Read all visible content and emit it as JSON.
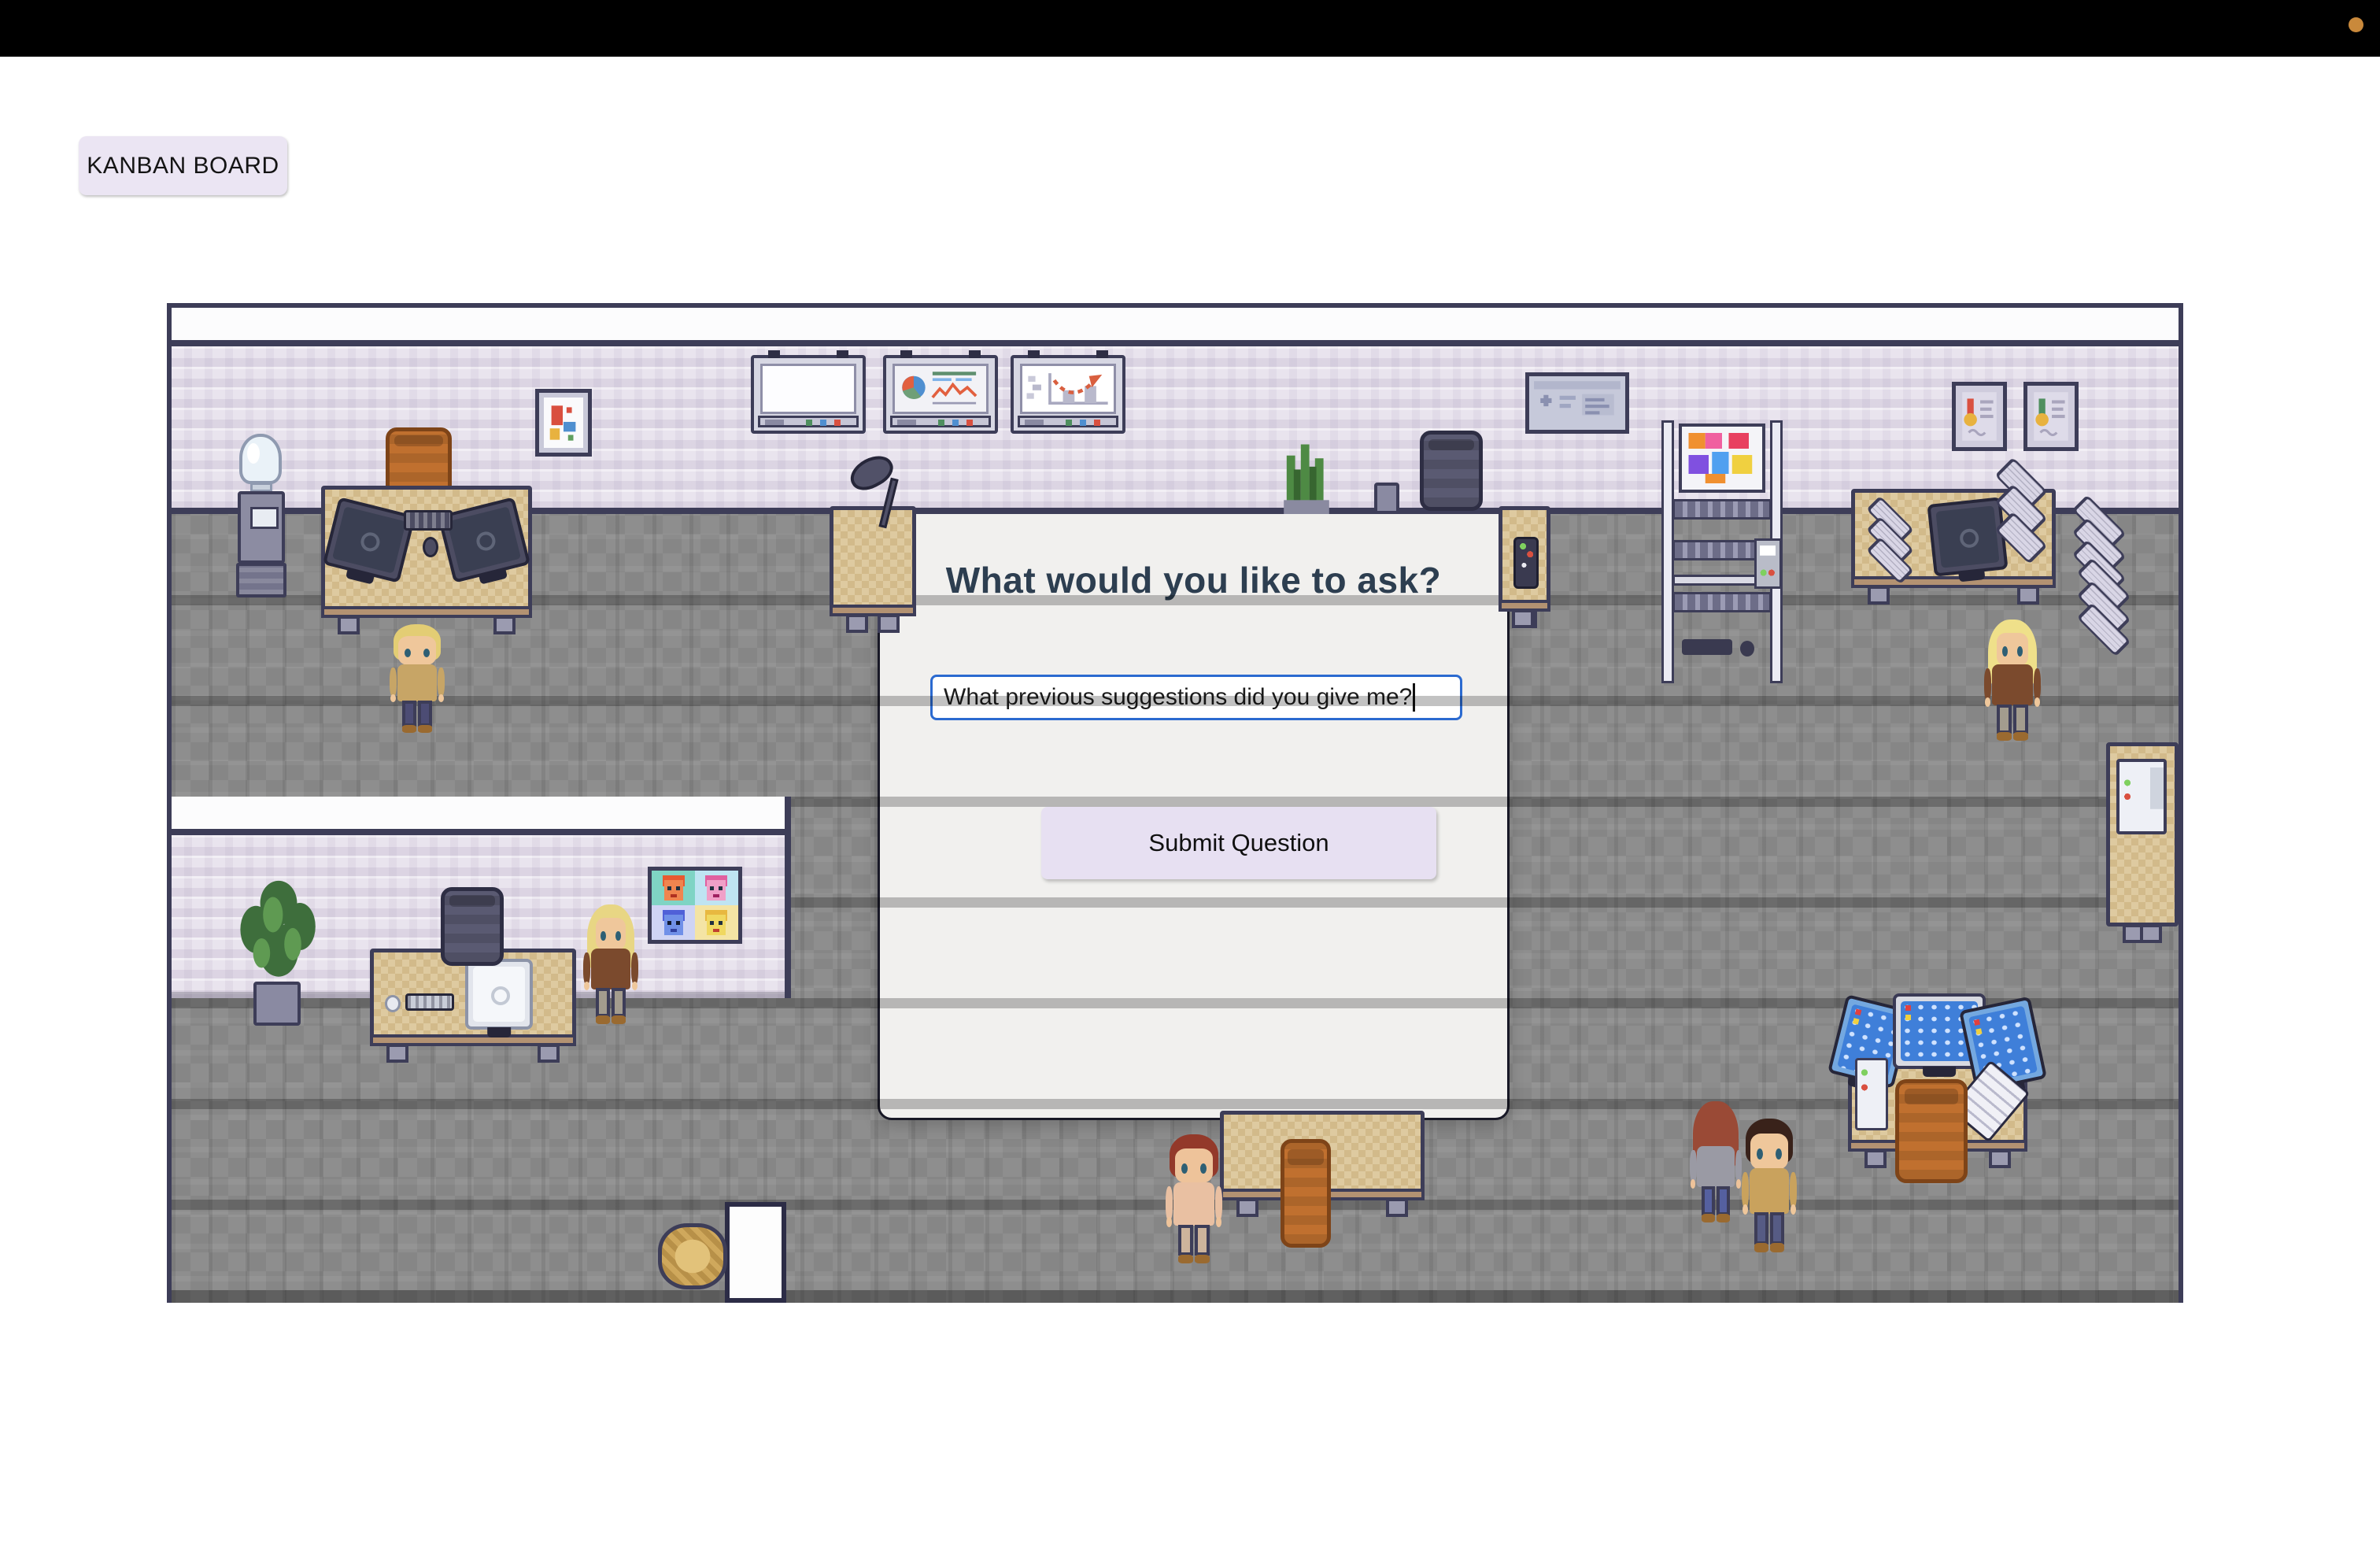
{
  "topbar": {
    "background": "#000000",
    "status_dot_color": "#c9893b"
  },
  "kanban_button": {
    "label": "KANBAN BOARD"
  },
  "modal": {
    "title": "What would you like to ask?",
    "input_value": "What previous suggestions did you give me?",
    "submit_label": "Submit Question"
  },
  "colors": {
    "page_background": "#ffffff",
    "modal_background": "#f1f0ee",
    "modal_border": "#181826",
    "input_border": "#2b6ad0",
    "button_background": "#e7e0f2",
    "title_color": "#2d3e50",
    "wall": "#e9e4ee",
    "floor": "#8e8e8e",
    "outline": "#3d3d58",
    "desk": "#decaa0",
    "chair_orange": "#c0702f"
  },
  "scene": {
    "type": "pixel-art-office-map",
    "rooms": [
      "main-office",
      "side-office"
    ],
    "characters": [
      "blond-man",
      "blonde-woman-at-desk",
      "blonde-woman-right",
      "red-haired-man",
      "brown-haired-man",
      "long-haired-person-back"
    ]
  }
}
